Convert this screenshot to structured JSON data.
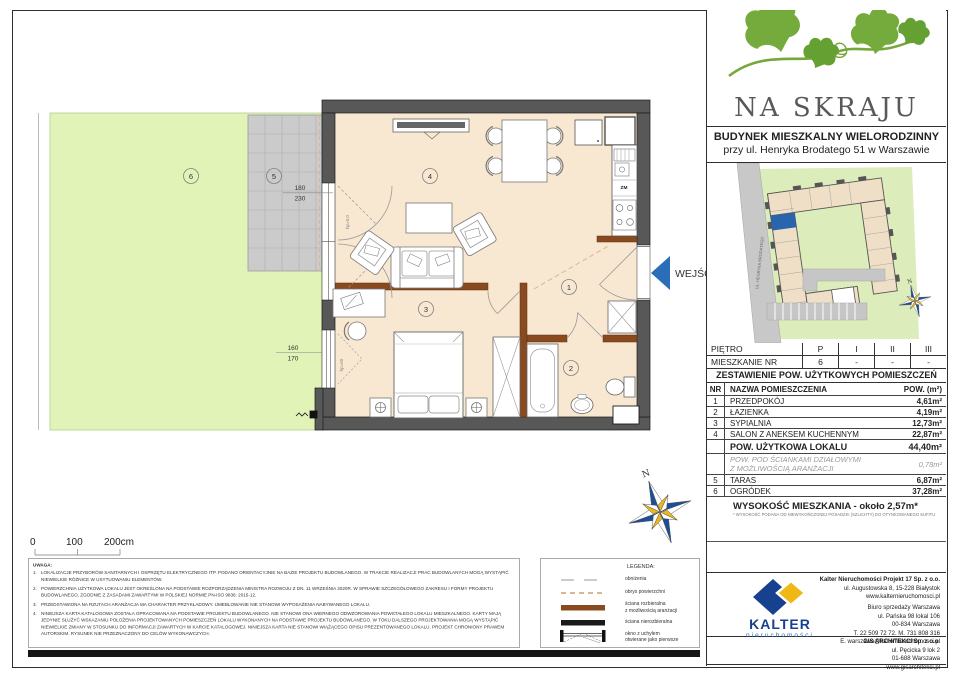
{
  "header": {
    "logo_text": "NA SKRAJU",
    "building_line1": "BUDYNEK MIESZKALNY WIELORODZINNY",
    "building_line2": "przy ul. Henryka Brodatego 51 w Warszawie"
  },
  "site_map": {
    "street_label": "UL. HENRYKA BRODATEGO",
    "north_label": "N"
  },
  "plan": {
    "entrance_label": "WEJŚCIE",
    "north_label": "N",
    "marker_1": "1",
    "marker_2": "2",
    "marker_3": "3",
    "marker_4": "4",
    "marker_5": "5",
    "marker_6": "6",
    "dim_terrace_top": "180",
    "dim_terrace_bottom": "230",
    "dim_window_top": "160",
    "dim_window_bottom": "170",
    "hp_terrace": "hp=0,0",
    "hp_window": "hp=60",
    "kitchen_dishwasher": "ZM"
  },
  "scale_bar": {
    "zero": "0",
    "hundred": "100",
    "twohundred": "200cm"
  },
  "notes": {
    "title": "UWAGA:",
    "items": [
      {
        "num": "1.",
        "text": "LOKALIZACJE PRZYBORÓW SANITARNYCH I OSPRZĘTU ELEKTRYCZNEGO ITP. PODANO ORIENTACYJNIE NA BAZIE PROJEKTU BUDOWLANEGO. W TRAKCIE REALIZACJI PRAC BUDOWLANYCH MOGĄ WYSTĄPIĆ NIEWIELKIE RÓŻNICE W USYTUOWANIU ELEMENTÓW."
      },
      {
        "num": "2.",
        "text": "POWIERZCHNIA UŻYTKOWA LOKALU JEST OKREŚLONA NA PODSTAWIE ROZPORZĄDZENIA MINISTRA ROZWOJU Z DN. 11 WRZEŚNIA 2020R. W SPRAWIE SZCZEGÓŁOWEGO ZAKRESU I FORMY PROJEKTU BUDOWLANEGO, ZGODNIE Z ZASADAMI ZAWARTYMI W POLSKIEJ NORMIE PN-ISO 9836: 2015-12."
      },
      {
        "num": "3.",
        "text": "PRZEDSTAWIONA NA RZUTACH ARANŻACJA MA CHARAKTER PRZYKŁADOWY. UMEBLOWANIE NIE STANOWI WYPOSAŻENIA NABYWANEGO LOKALU."
      },
      {
        "num": "4.",
        "text": "NINIEJSZA KARTA KATALOGOWA ZOSTAŁA OPRACOWANA NA PODSTAWIE PROJEKTU BUDOWLANEGO. NIE STANOWI ONA WIERNEGO ODWZOROWANIA POWSTAŁEGO LOKALU MIESZKALNEGO. KARTY MAJĄ JEDYNIE SŁUŻYĆ WSKAZANIU POŁOŻENIA PROJEKTOWANYCH POMIESZCZEŃ LOKALU WYKONANYCH NA PODSTAWIE PROJEKTU BUDOWLANEGO. W TOKU DALSZEGO PROJEKTOWANIA MOGĄ WYSTĄPIĆ NIEWIELKIE ZMIANY W STOSUNKU DO INFORMACJI ZAWARTYCH W KARCIE KATALOGOWEJ. NINIEJSZA KARTA NIE STANOWI WIĄŻĄCEGO OPISU PREZENTOWANEGO LOKALU. PROJEKT CHRONIONY PRAWEM AUTORSKIM. RYSUNEK NIE PRZEZNACZONY DO CELÓW WYKONAWCZYCH."
      }
    ]
  },
  "legend": {
    "title": "LEGENDA:",
    "item_lowering": "obniżenia",
    "item_outline": "obrys powierzchni",
    "item_removable_1": "ściana rozbieralna",
    "item_removable_2": "z możliwością aranżacji",
    "item_fixed": "ściana nierozbieralna",
    "item_window_1": "okno z uchyłem",
    "item_window_2": "otwierane jako pierwsze"
  },
  "floor_table": {
    "row1_label": "PIĘTRO",
    "row1": [
      "P",
      "I",
      "II",
      "III"
    ],
    "row2_label": "MIESZKANIE NR",
    "row2": [
      "6",
      "-",
      "-",
      "-"
    ]
  },
  "area_table": {
    "title": "ZESTAWIENIE POW. UŻYTKOWYCH POMIESZCZEŃ",
    "col_nr": "NR",
    "col_name": "NAZWA POMIESZCZENIA",
    "col_area": "POW. (m²)",
    "rows": [
      {
        "nr": "1",
        "name": "PRZEDPOKÓJ",
        "area": "4,61m²"
      },
      {
        "nr": "2",
        "name": "ŁAZIENKA",
        "area": "4,19m²"
      },
      {
        "nr": "3",
        "name": "SYPIALNIA",
        "area": "12,73m²"
      },
      {
        "nr": "4",
        "name": "SALON Z ANEKSEM KUCHENNYM",
        "area": "22,87m²"
      }
    ],
    "total_label": "POW. UŻYTKOWA LOKALU",
    "total_area": "44,40m²",
    "partition_label_1": "POW. POD ŚCIANKAMI DZIAŁOWYMI",
    "partition_label_2": "Z MOŻLIWOŚCIĄ ARANŻACJI",
    "partition_area": "0,78m²",
    "outdoor_rows": [
      {
        "nr": "5",
        "name": "TARAS",
        "area": "6,87m²"
      },
      {
        "nr": "6",
        "name": "OGRÓDEK",
        "area": "37,28m²"
      }
    ],
    "height_label": "WYSOKOŚĆ MIESZKANIA - około 2,57m*",
    "height_footnote": "* WYSOKOŚĆ PODANA OD NIEWYKOŃCZONEJ POSADZKI (SZLICHTY) DO OTYNKOWANEGO SUFITU"
  },
  "companies": {
    "kalter_wordmark": "KALTER",
    "kalter_tagline": "nieruchomości",
    "main_name": "Kalter Nieruchomości Projekt 17 Sp. z o.o.",
    "main_lines": [
      "ul. Augustowska 8, 15-228 Białystok",
      "www.kalternieruchomosci.pl"
    ],
    "office_lines": [
      "Biuro sprzedaży Warszawa",
      "ul. Pańska 98 lokal 106",
      "00-834 Warszawa",
      "T. 22 509 72 72. M. 731 808 316",
      "E. warszawa@kalternieruchomosci.pl"
    ],
    "architect_name": "GIS ARCHITEKCI Sp. z o.o.",
    "architect_lines": [
      "ul. Pęcicka 9 lok 2",
      "01-688 Warszawa",
      "www.gisarchitekci.pl"
    ]
  },
  "colors": {
    "wall_dark": "#585858",
    "wall_removable_brown": "#8a4a1f",
    "floor_cream": "#f8e7d1",
    "garden_green": "#e2f3b8",
    "terrace_gray": "#cbcbcb",
    "outline_tan_dash": "#d8b894",
    "entrance_blue": "#2a6db8",
    "logo_green": "#74ab3c",
    "kalter_navy": "#17418f",
    "kalter_yellow": "#f0b816"
  }
}
